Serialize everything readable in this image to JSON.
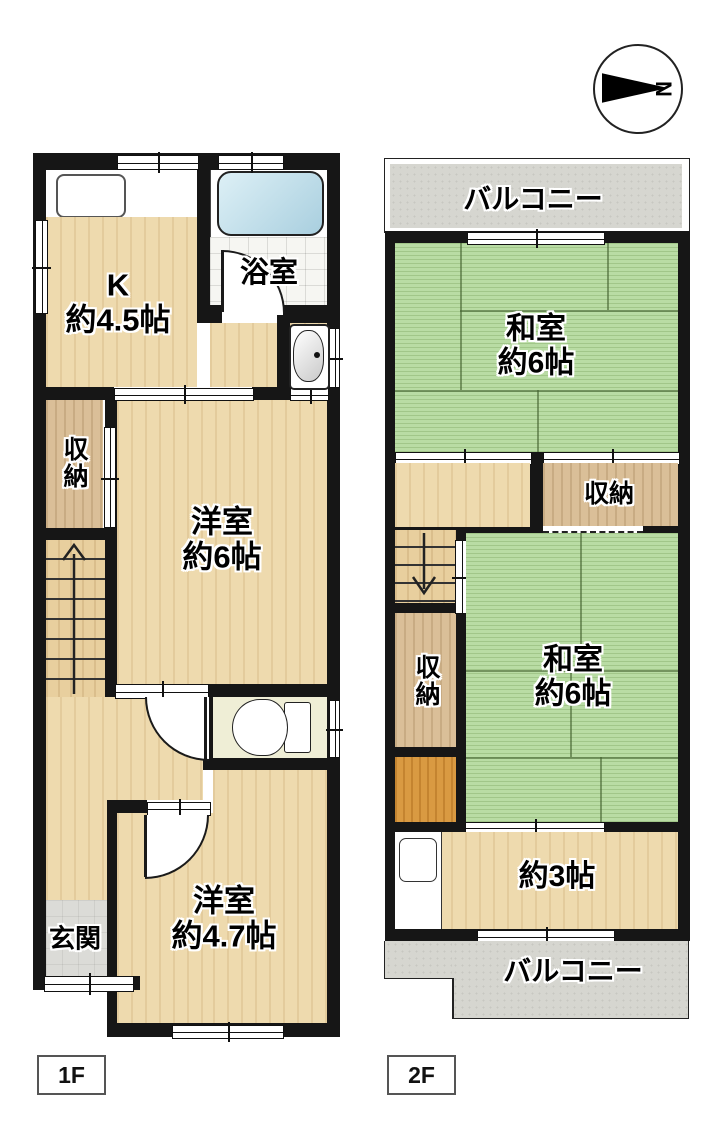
{
  "compass": {
    "label": "N"
  },
  "tags": {
    "f1": "1F",
    "f2": "2F"
  },
  "f1": {
    "kitchen": "K\n約4.5帖",
    "bath": "浴室",
    "storage": "収納",
    "room6": "洋室\n約6帖",
    "entrance": "玄関",
    "room47": "洋室\n約4.7帖"
  },
  "f2": {
    "balcony_top": "バルコニー",
    "wa_upper": "和室\n約6帖",
    "storage_right": "収納",
    "storage_left": "収納",
    "wa_lower": "和室\n約6帖",
    "room3": "約3帖",
    "balcony_bottom": "バルコニー"
  },
  "colors": {
    "wall": "#161616",
    "wood": "#eedaae",
    "tatami": "#b9dca4",
    "closet": "#dabf98",
    "balcony": "#d6d6d0",
    "entrance_tile": "#dbdbd7",
    "tub": "#bfe0ee",
    "orange_closet": "#d99a42",
    "toilet_floor": "#efeed6"
  }
}
